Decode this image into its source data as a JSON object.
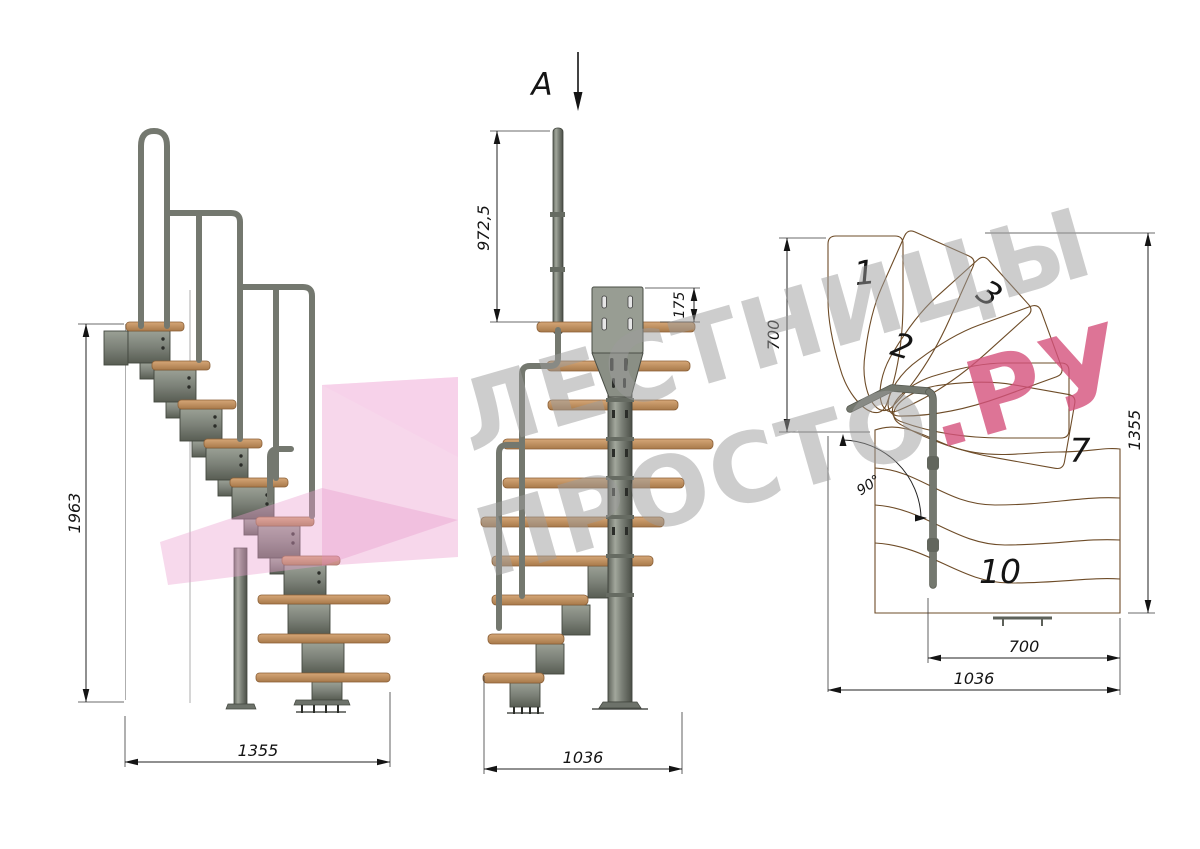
{
  "drawing": {
    "section_label": "А",
    "side_view": {
      "height_dim": "1963",
      "width_dim": "1355"
    },
    "front_view": {
      "rail_height_dim": "972,5",
      "bracket_dim": "175",
      "depth_dim": "1036"
    },
    "plan_view": {
      "entry_dim": "700",
      "length_dim": "1355",
      "angle_dim": "90°",
      "flight_width_dim": "700",
      "depth_dim": "1036",
      "tread_numbers": [
        "1",
        "2",
        "3",
        "7",
        "10"
      ]
    }
  },
  "watermark": {
    "line1": "ЛЕСТНИЦЫ",
    "line2": "ПРОСТО",
    "line2_accent": ".РУ"
  },
  "colors": {
    "wood": "#c99767",
    "wood_dark": "#b3854f",
    "metal": "#7c8178",
    "metal_dark": "#43473f",
    "dim_line": "#222222",
    "watermark_gray": "#9c9c9c",
    "watermark_pink": "#d4517c",
    "arrow_pink": "#ec9fd0"
  }
}
